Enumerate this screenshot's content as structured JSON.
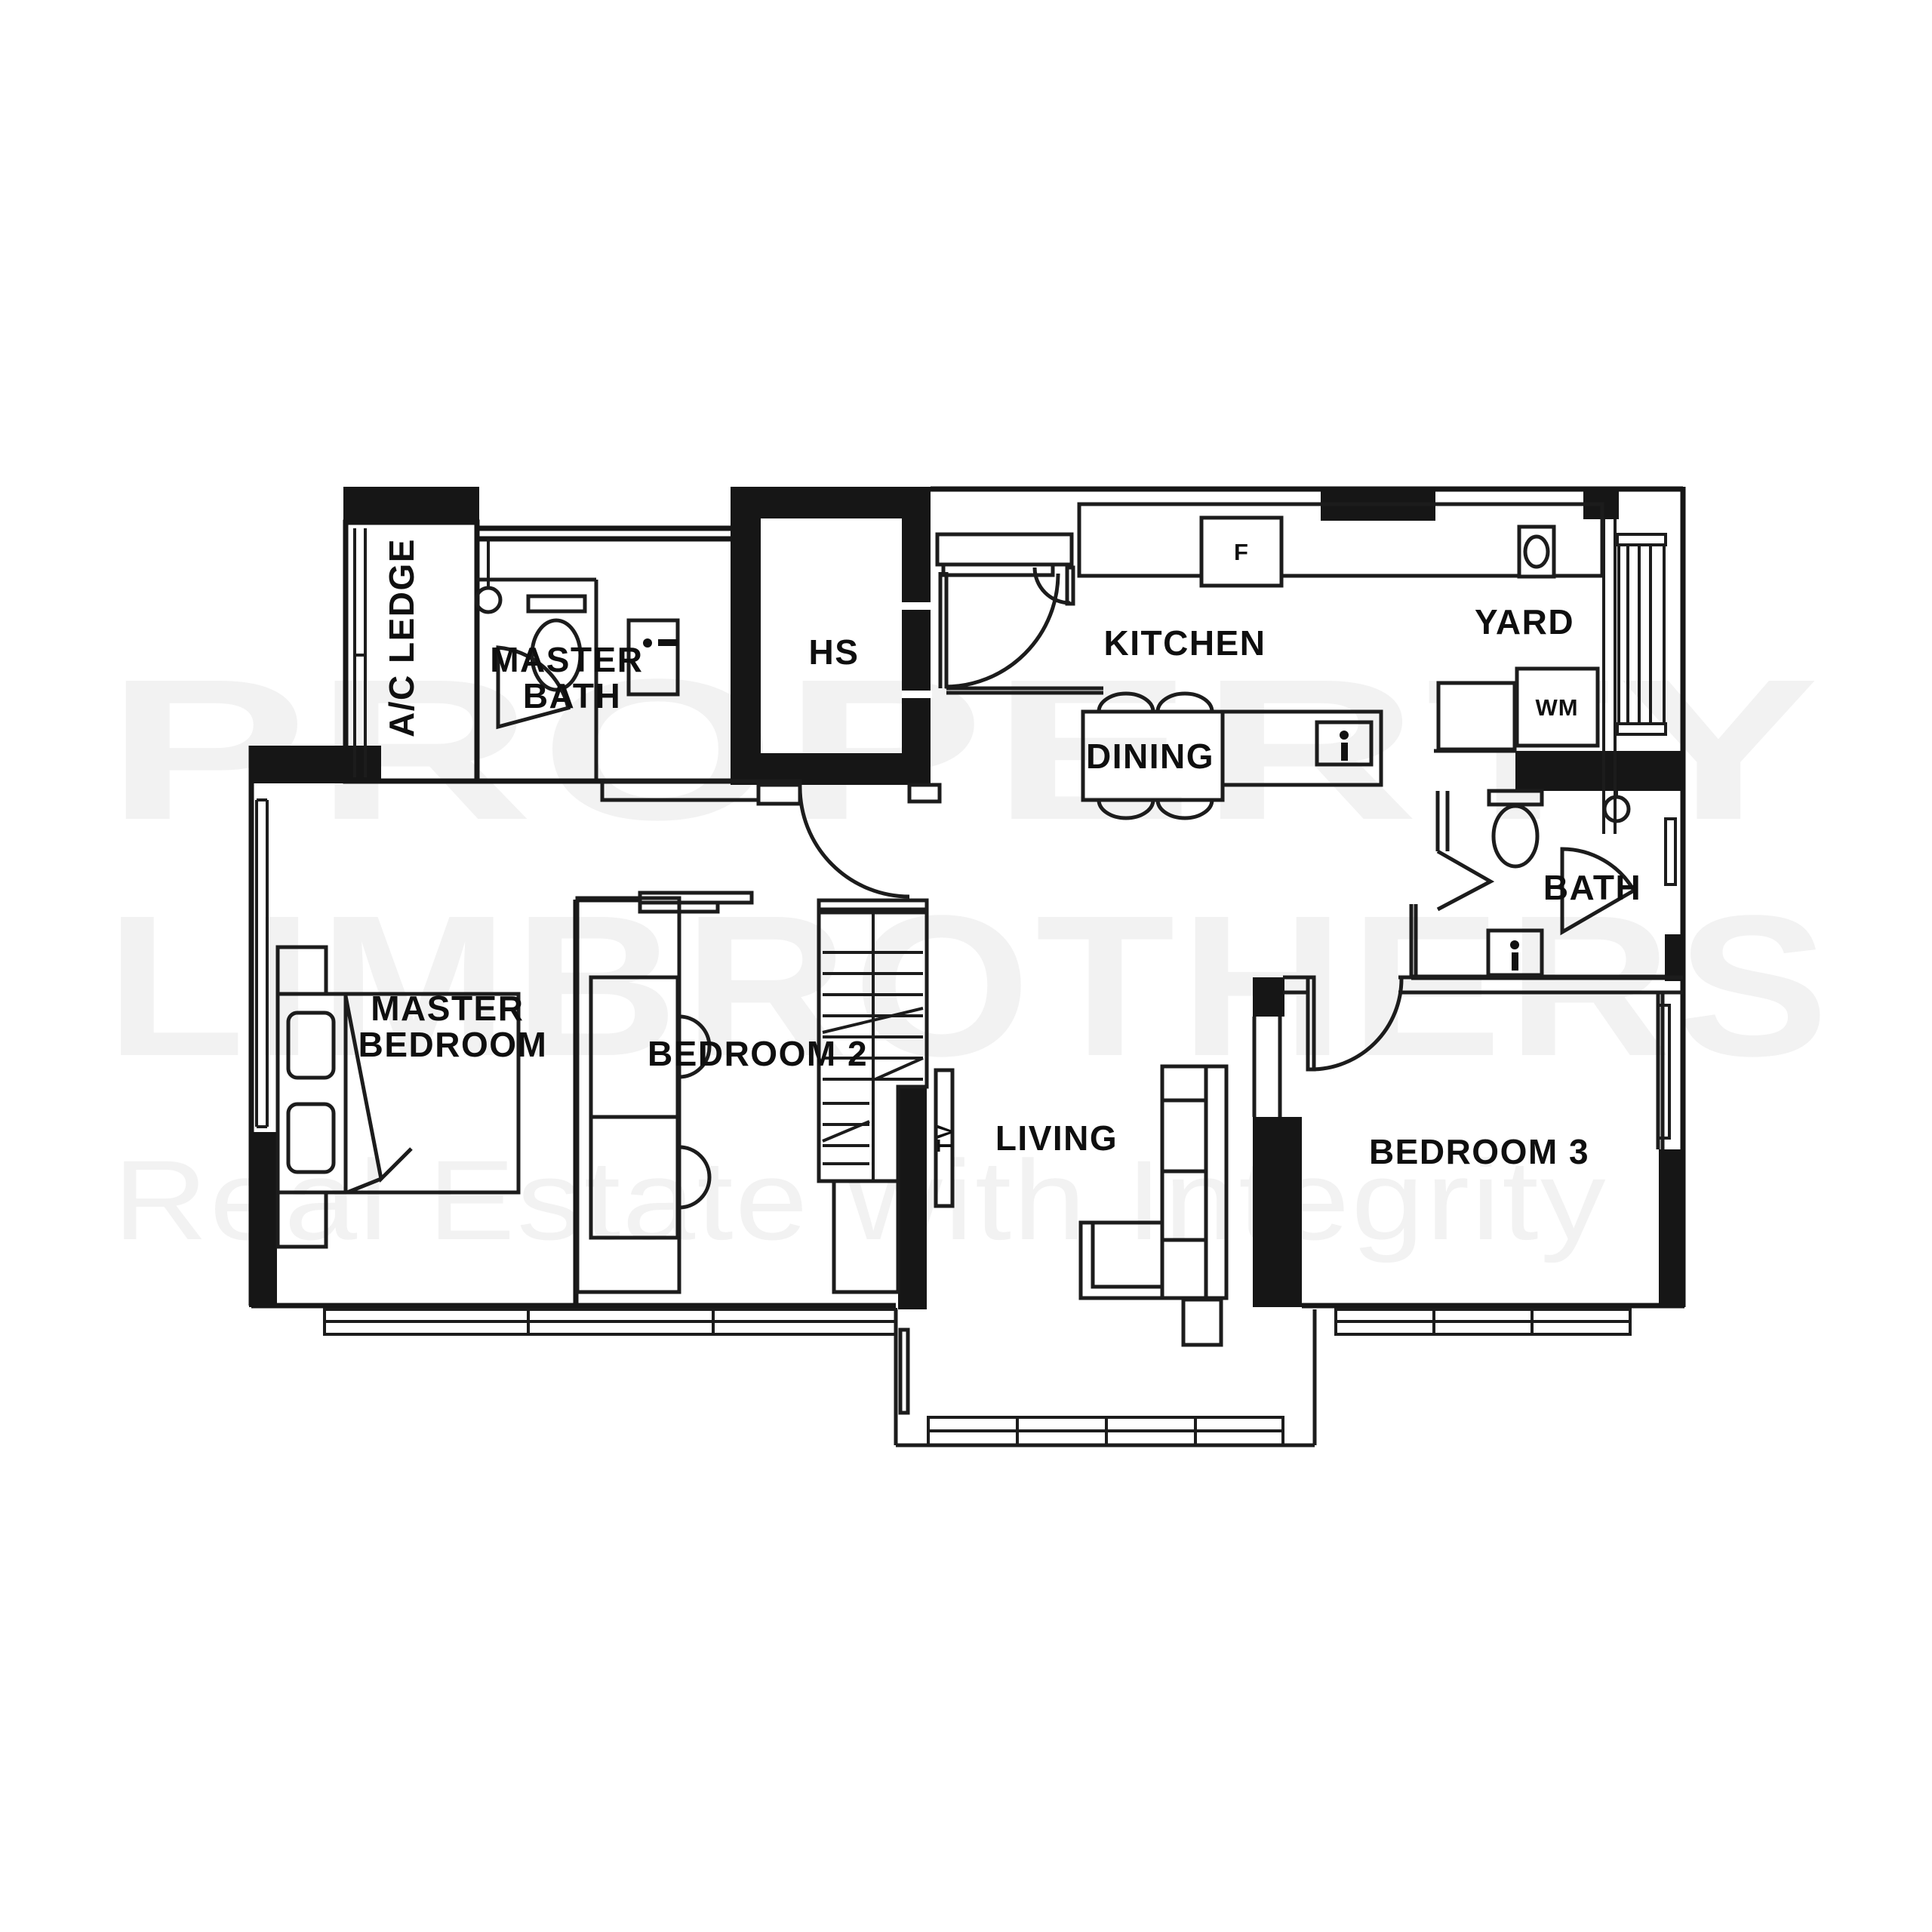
{
  "watermark": {
    "line1": "PROPERTY",
    "line2": "LIMBROTHERS",
    "tagline": "Real Estate with Integrity",
    "color": "#f2f2f2"
  },
  "rooms": {
    "ac_ledge": {
      "label": "A/C LEDGE"
    },
    "master_bath": {
      "line1": "MASTER",
      "line2": "BATH"
    },
    "hs": {
      "label": "HS"
    },
    "kitchen": {
      "label": "KITCHEN"
    },
    "yard": {
      "label": "YARD"
    },
    "dining": {
      "label": "DINING"
    },
    "bath": {
      "label": "BATH"
    },
    "master_bedroom": {
      "line1": "MASTER",
      "line2": "BEDROOM"
    },
    "bedroom2": {
      "label": "BEDROOM 2"
    },
    "living": {
      "label": "LIVING"
    },
    "bedroom3": {
      "label": "BEDROOM 3"
    }
  },
  "fixtures": {
    "fridge": "F",
    "washing_machine": "WM",
    "tv": "TV"
  },
  "colors": {
    "background": "#ffffff",
    "wall": "#161616",
    "line": "#1c1c1c",
    "watermark": "#f2f2f2"
  }
}
